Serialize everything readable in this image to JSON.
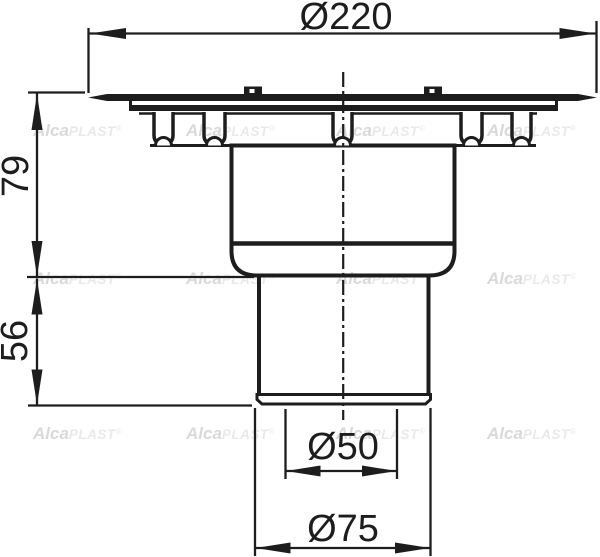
{
  "dimensions": {
    "flange_diameter": "Ø220",
    "body_height": "79",
    "outlet_height": "56",
    "outlet_inner_diameter": "Ø50",
    "outlet_outer_diameter": "Ø75"
  },
  "watermark": {
    "alca": "Alca",
    "plast": "PLAST",
    "reg": "®"
  },
  "colors": {
    "line": "#1d1d1d",
    "background": "#ffffff",
    "watermark_bold": "#d9d9d9",
    "watermark_light": "#e9e9e9"
  }
}
